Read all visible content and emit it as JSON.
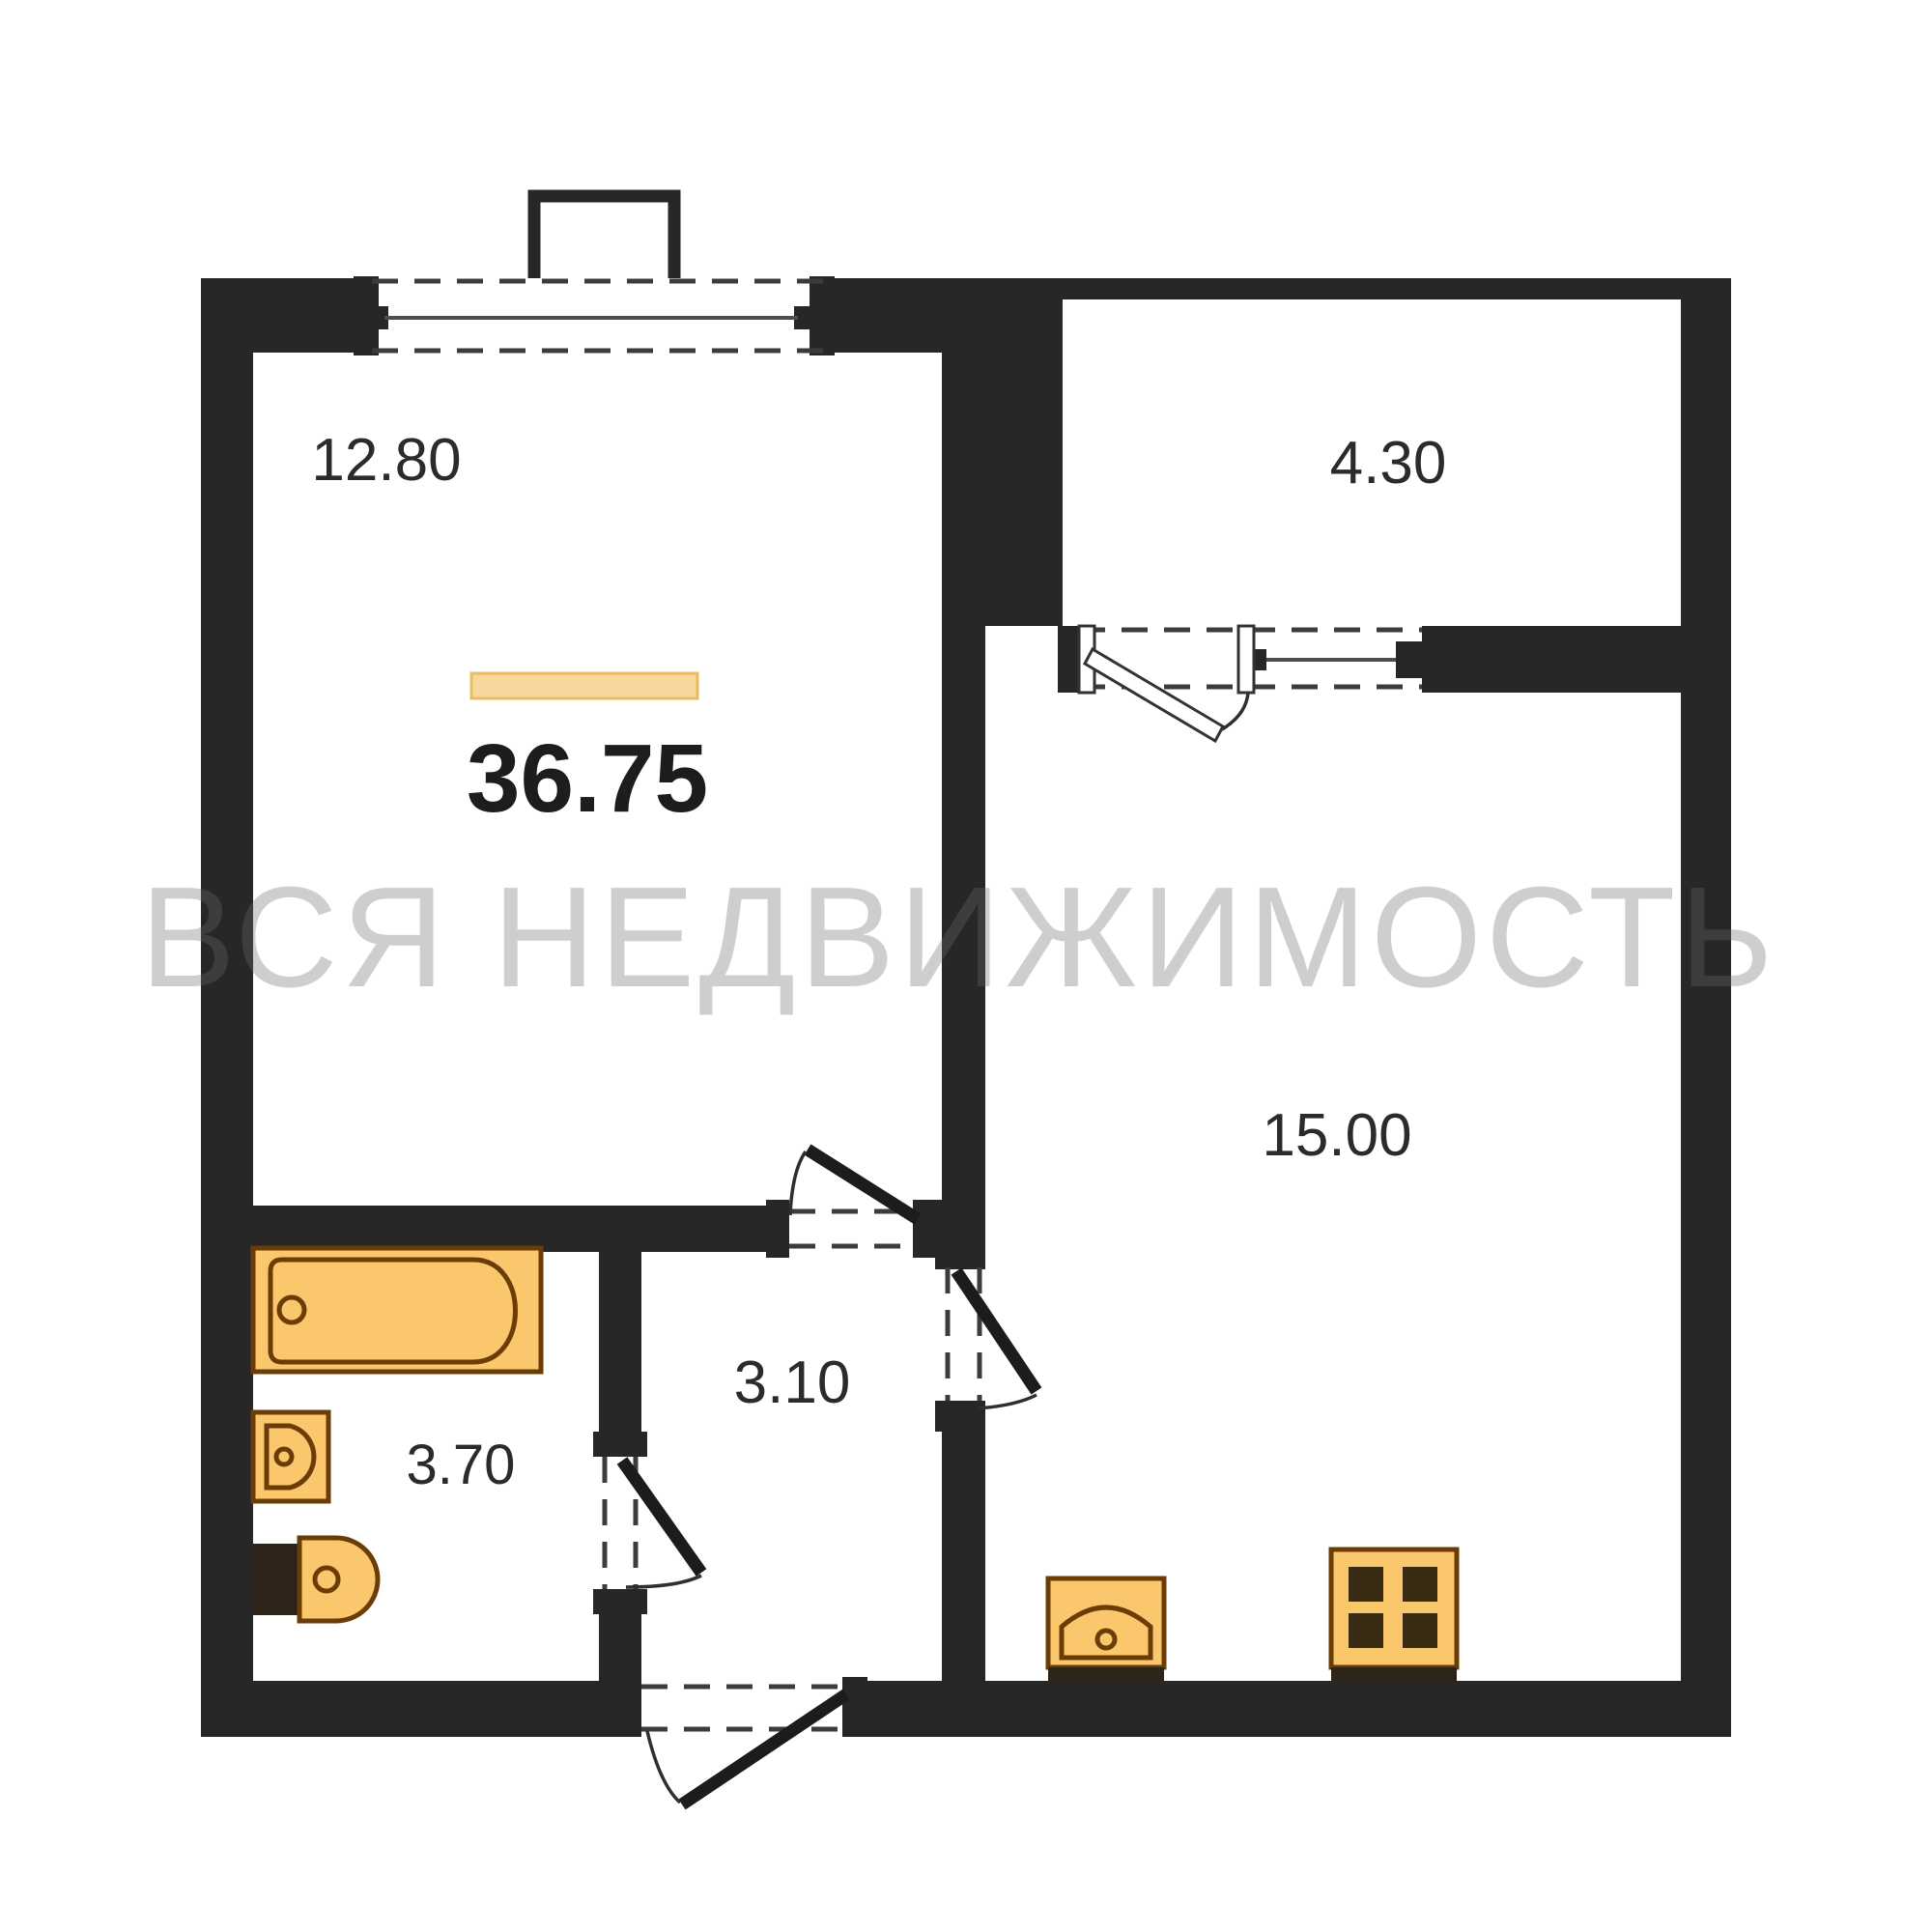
{
  "title": "Apartment floor plan",
  "watermark": {
    "text": "ВСЯ НЕДВИЖИМОСТЬ"
  },
  "total": {
    "area": "36.75"
  },
  "rooms": [
    {
      "name": "living-room",
      "area": "12.80"
    },
    {
      "name": "loggia",
      "area": "4.30"
    },
    {
      "name": "kitchen-living-room",
      "area": "15.00"
    },
    {
      "name": "hallway",
      "area": "3.10"
    },
    {
      "name": "bathroom",
      "area": "3.70"
    }
  ],
  "fixtures": [
    "bathtub-icon",
    "washbasin-icon",
    "toilet-icon",
    "kitchen-sink-icon",
    "stove-icon"
  ],
  "colors": {
    "wall": "#272727",
    "door": "#1c1c1c",
    "dash": "#3c3c3c",
    "winline": "#4e4e4e",
    "fixture": "#FAC76D",
    "fixtureLine": "#6B3D06",
    "fixtureDark": "#2E2419",
    "burner": "#3A2C14",
    "bar": "#F8D79E",
    "barLine": "#E9BC62",
    "text": "#2B2B2B",
    "totalText": "#1D1D1D",
    "paper": "#FFFFFF"
  }
}
